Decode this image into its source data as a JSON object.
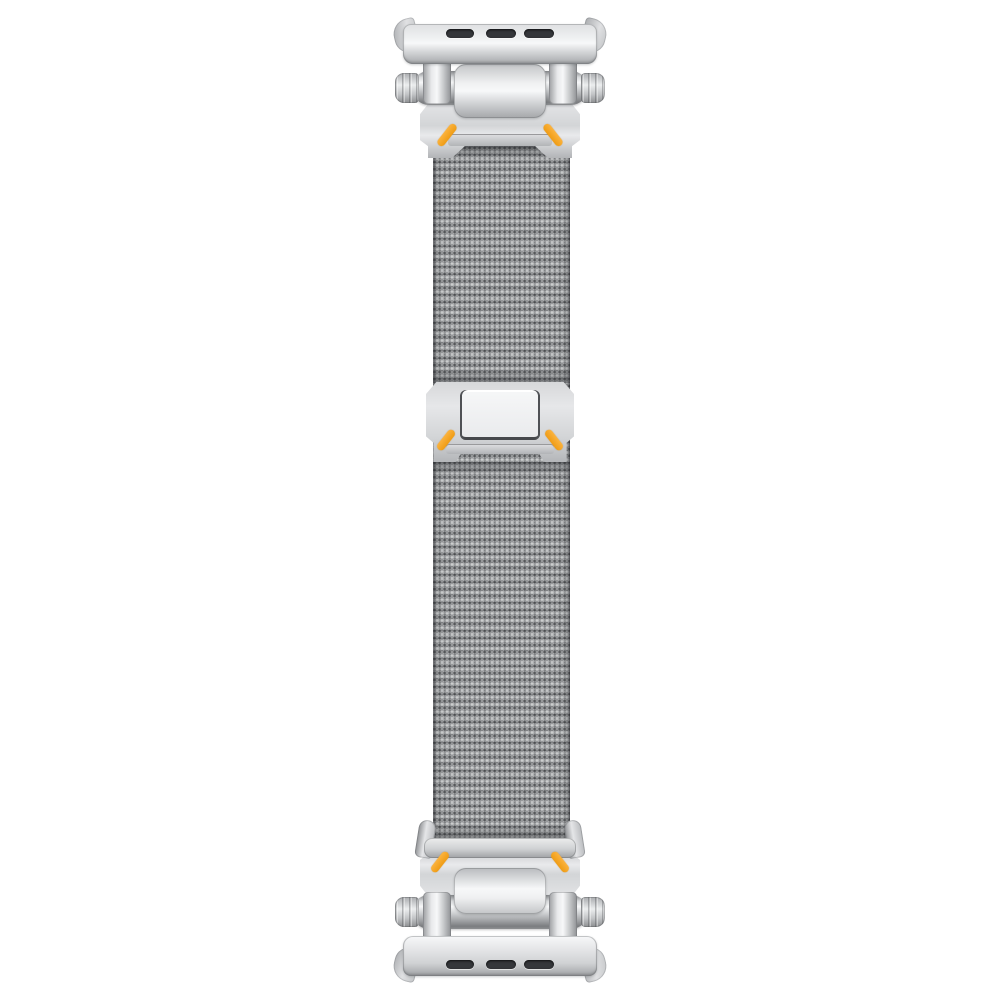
{
  "scene": {
    "background": "#ffffff",
    "subject": "silver milanese mesh watch band with rugged hinged lug adapters and orange accent marks"
  },
  "colors": {
    "background": "#ffffff",
    "metal_highlight": "#f7f8f9",
    "metal_light": "#e8e9eb",
    "metal_mid": "#d0d2d4",
    "metal_shadow": "#a6a8ab",
    "metal_edge": "#7e8184",
    "metal_deep": "#7b7d80",
    "slot_dark": "#35373b",
    "accent_orange": "#f6a428",
    "accent_orange_light": "#fbb33f",
    "accent_orange_deep": "#ef9c14",
    "mesh_base": "#96989a",
    "mesh_light": "#c6c8ca",
    "mesh_dark": "#55575a",
    "inner_plate_light": "#f6f7f8",
    "inner_plate_rim": "#4f5155"
  },
  "parts": {
    "canvas": "watch band product photo",
    "mesh_strap": "milanese mesh strap",
    "top_connector": "top lug connector assembly",
    "bottom_connector": "bottom lug connector assembly",
    "lug_adapter_bar": "watch lug adapter bar with release slots",
    "lug_slot": "band release slot",
    "adapter_wing": "flared adapter wing",
    "hinge_strap": "hinge strap link",
    "hinge_barrel": "hinge barrel pin",
    "barrel_cap": "knurled barrel end cap",
    "hinge_knuckle": "hinge knuckle cover",
    "connector_plate": "angular connector face plate",
    "accent_dash": "orange accent mark",
    "slide_clasp": "sliding clasp plate",
    "clasp_inner_plate": "clasp inner pressure plate",
    "buckle_arm": "strap guide side arm",
    "buckle_crossbar": "strap guide crossbar"
  }
}
